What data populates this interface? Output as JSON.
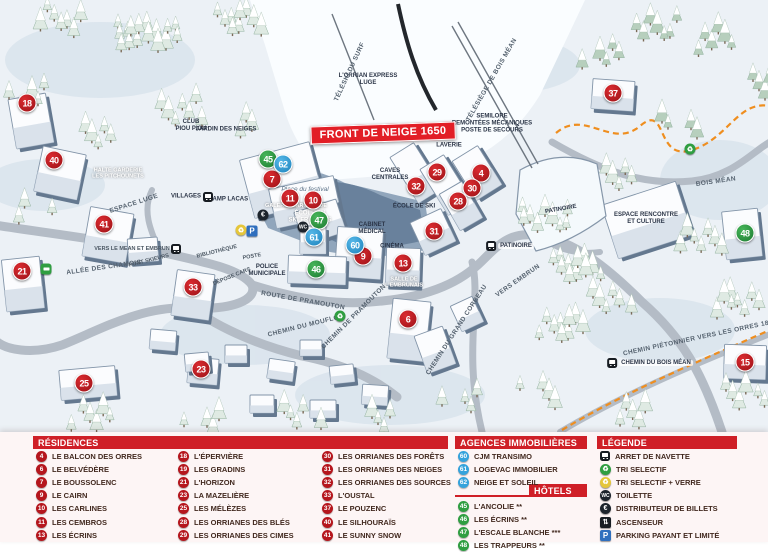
{
  "map": {
    "banner": {
      "text": "FRONT DE NEIGE 1650"
    },
    "labels": [
      {
        "name": "lift-orrian-express",
        "text": "L'ORRIAN EXPRESS\nLUGE",
        "x": 368,
        "y": 80,
        "rot": 0,
        "style": "dark"
      },
      {
        "name": "teleski-du-surf",
        "text": "TÉLÉSKI DU SURF",
        "x": 350,
        "y": 72,
        "rot": -65,
        "style": "road"
      },
      {
        "name": "telesiege-bois-mean",
        "text": "TÉLÉSIÈGE DE BOIS MÉAN",
        "x": 492,
        "y": 80,
        "rot": -60,
        "style": "road"
      },
      {
        "name": "semilore-remontees",
        "text": "SEMILORE\nREMONTÉES MÉCANIQUES\nPOSTE DE SECOURS",
        "x": 492,
        "y": 124,
        "rot": 0,
        "style": "dark"
      },
      {
        "name": "laverie",
        "text": "LAVERIE",
        "x": 449,
        "y": 146,
        "rot": 0,
        "style": "dark"
      },
      {
        "name": "club-piou-piou",
        "text": "CLUB\nPIOU PIOU",
        "x": 191,
        "y": 126,
        "rot": 0,
        "style": "dark"
      },
      {
        "name": "jardin-des-neiges",
        "text": "JARDIN DES NEIGES",
        "x": 226,
        "y": 130,
        "rot": 0,
        "style": "dark"
      },
      {
        "name": "halte-garderie",
        "text": "HALTE GARDERIE\nLES PITCHOUNETS",
        "x": 118,
        "y": 174,
        "rot": 0,
        "style": "onbld"
      },
      {
        "name": "espace-luge",
        "text": "ESPACE LUGE",
        "x": 134,
        "y": 204,
        "rot": -18,
        "style": "road"
      },
      {
        "name": "villages",
        "text": "VILLAGES",
        "x": 186,
        "y": 197,
        "rot": 0,
        "style": "dark"
      },
      {
        "name": "champ-lacas",
        "text": "CHAMP LACAS",
        "x": 226,
        "y": 200,
        "rot": 0,
        "style": "dark"
      },
      {
        "name": "place-du-festival",
        "text": "Place du festival",
        "x": 305,
        "y": 190,
        "rot": 0,
        "style": "italic"
      },
      {
        "name": "la-bulle-esf",
        "text": "LA BULLE\nÉCOLE DU\nSKI FRANÇAIS",
        "x": 310,
        "y": 214,
        "rot": 0,
        "style": "onblue"
      },
      {
        "name": "galerie-marchande",
        "text": "GALERIE MARCHANDE",
        "x": 296,
        "y": 206,
        "rot": 0,
        "style": "onbld"
      },
      {
        "name": "caves-centrales",
        "text": "CAVES\nCENTRALES",
        "x": 390,
        "y": 175,
        "rot": 0,
        "style": "dark"
      },
      {
        "name": "ecole-de-ski",
        "text": "ÉCOLE DE SKI",
        "x": 414,
        "y": 207,
        "rot": 0,
        "style": "dark"
      },
      {
        "name": "cabinet-medical",
        "text": "CABINET\nMÉDICAL",
        "x": 372,
        "y": 229,
        "rot": 0,
        "style": "dark"
      },
      {
        "name": "cinema",
        "text": "CINÉMA",
        "x": 392,
        "y": 247,
        "rot": 0,
        "style": "dark"
      },
      {
        "name": "salle-embrunais",
        "text": "SALLE DE\nL'EMBRUNAIS",
        "x": 404,
        "y": 283,
        "rot": 0,
        "style": "onbld"
      },
      {
        "name": "bibliotheque",
        "text": "BIBLIOTHÈQUE",
        "x": 217,
        "y": 252,
        "rot": -14,
        "style": "roadsm"
      },
      {
        "name": "poste",
        "text": "POSTE",
        "x": 252,
        "y": 257,
        "rot": -10,
        "style": "roadsm"
      },
      {
        "name": "depose-cars",
        "text": "DÉPOSE CARS",
        "x": 232,
        "y": 277,
        "rot": -22,
        "style": "roadsm"
      },
      {
        "name": "police-municipale",
        "text": "POLICE\nMUNICIPALE",
        "x": 267,
        "y": 271,
        "rot": 0,
        "style": "dark"
      },
      {
        "name": "route-de-pramouton",
        "text": "ROUTE DE PRAMOUTON",
        "x": 303,
        "y": 301,
        "rot": 10,
        "style": "road"
      },
      {
        "name": "chemin-du-mouflon",
        "text": "CHEMIN DU MOUFLON",
        "x": 306,
        "y": 326,
        "rot": -14,
        "style": "road"
      },
      {
        "name": "chemin-de-pramouton",
        "text": "CHEMIN DE PRAMOUTON",
        "x": 354,
        "y": 317,
        "rot": -45,
        "style": "road"
      },
      {
        "name": "chemin-grand-corbeau",
        "text": "CHEMIN DU GRAND CORBEAU",
        "x": 457,
        "y": 330,
        "rot": -57,
        "style": "road"
      },
      {
        "name": "vers-embrun",
        "text": "VERS EMBRUN",
        "x": 518,
        "y": 281,
        "rot": -35,
        "style": "road"
      },
      {
        "name": "allee-des-chamois",
        "text": "ALLÉE DES CHAMOIS",
        "x": 104,
        "y": 268,
        "rot": -8,
        "style": "road"
      },
      {
        "name": "pont-skieurs",
        "text": "PONT SKIEURS",
        "x": 149,
        "y": 261,
        "rot": -14,
        "style": "roadsm"
      },
      {
        "name": "vers-le-mean",
        "text": "VERS LE MEAN ET EMBRUN",
        "x": 132,
        "y": 249,
        "rot": 0,
        "style": "roadsm"
      },
      {
        "name": "chemin-pietonnier",
        "text": "CHEMIN PIÉTONNIER\nVERS LES ORRES 1800",
        "x": 700,
        "y": 338,
        "rot": -12,
        "style": "road"
      },
      {
        "name": "bois-mean",
        "text": "BOIS MÉAN",
        "x": 716,
        "y": 182,
        "rot": -8,
        "style": "road"
      },
      {
        "name": "patinoire-building",
        "text": "PATINOIRE",
        "x": 561,
        "y": 210,
        "rot": -10,
        "style": "dark"
      },
      {
        "name": "espace-rencontre",
        "text": "ESPACE RENCONTRE\nET CULTURE",
        "x": 646,
        "y": 219,
        "rot": 0,
        "style": "dark"
      }
    ],
    "markers": [
      {
        "n": "18",
        "color": "red",
        "x": 27,
        "y": 103
      },
      {
        "n": "40",
        "color": "red",
        "x": 54,
        "y": 160
      },
      {
        "n": "41",
        "color": "red",
        "x": 104,
        "y": 224
      },
      {
        "n": "21",
        "color": "red",
        "x": 22,
        "y": 271
      },
      {
        "n": "33",
        "color": "red",
        "x": 193,
        "y": 287
      },
      {
        "n": "25",
        "color": "red",
        "x": 84,
        "y": 383
      },
      {
        "n": "23",
        "color": "red",
        "x": 201,
        "y": 369
      },
      {
        "n": "7",
        "color": "red",
        "x": 272,
        "y": 179
      },
      {
        "n": "11",
        "color": "red",
        "x": 290,
        "y": 198
      },
      {
        "n": "10",
        "color": "red",
        "x": 313,
        "y": 200
      },
      {
        "n": "9",
        "color": "red",
        "x": 363,
        "y": 256
      },
      {
        "n": "13",
        "color": "red",
        "x": 403,
        "y": 263
      },
      {
        "n": "6",
        "color": "red",
        "x": 408,
        "y": 319
      },
      {
        "n": "29",
        "color": "red",
        "x": 437,
        "y": 172
      },
      {
        "n": "4",
        "color": "red",
        "x": 481,
        "y": 173
      },
      {
        "n": "32",
        "color": "red",
        "x": 416,
        "y": 186
      },
      {
        "n": "30",
        "color": "red",
        "x": 472,
        "y": 188
      },
      {
        "n": "28",
        "color": "red",
        "x": 458,
        "y": 201
      },
      {
        "n": "31",
        "color": "red",
        "x": 434,
        "y": 231
      },
      {
        "n": "37",
        "color": "red",
        "x": 613,
        "y": 93
      },
      {
        "n": "15",
        "color": "red",
        "x": 745,
        "y": 362
      },
      {
        "n": "45",
        "color": "green",
        "x": 268,
        "y": 159
      },
      {
        "n": "47",
        "color": "green",
        "x": 319,
        "y": 220
      },
      {
        "n": "46",
        "color": "green",
        "x": 316,
        "y": 269
      },
      {
        "n": "48",
        "color": "green",
        "x": 745,
        "y": 233
      },
      {
        "n": "62",
        "color": "blue",
        "x": 283,
        "y": 164
      },
      {
        "n": "61",
        "color": "blue",
        "x": 314,
        "y": 237
      },
      {
        "n": "60",
        "color": "blue",
        "x": 355,
        "y": 245
      }
    ],
    "icons": [
      {
        "type": "euro",
        "x": 263,
        "y": 215
      },
      {
        "type": "parking",
        "x": 252,
        "y": 231
      },
      {
        "type": "triverre",
        "x": 241,
        "y": 230
      },
      {
        "type": "wc",
        "x": 303,
        "y": 227
      },
      {
        "type": "busgreen",
        "x": 46,
        "y": 269
      },
      {
        "type": "recycle",
        "x": 340,
        "y": 316
      },
      {
        "type": "recycle",
        "x": 690,
        "y": 149
      }
    ],
    "bus_stops": [
      {
        "x": 208,
        "y": 197,
        "label": ""
      },
      {
        "x": 176,
        "y": 249,
        "label": ""
      },
      {
        "x": 510,
        "y": 246,
        "label": "PATINOIRE"
      },
      {
        "x": 650,
        "y": 363,
        "label": "CHEMIN DU BOIS MÉAN"
      }
    ]
  },
  "panel": {
    "residences": {
      "title": "RÉSIDENCES",
      "columns": [
        [
          {
            "n": "4",
            "label": "LE BALCON DES ORRES"
          },
          {
            "n": "6",
            "label": "LE BELVÉDÈRE"
          },
          {
            "n": "7",
            "label": "LE BOUSSOLENC"
          },
          {
            "n": "9",
            "label": "LE CAIRN"
          },
          {
            "n": "10",
            "label": "LES CARLINES"
          },
          {
            "n": "11",
            "label": "LES CEMBROS"
          },
          {
            "n": "13",
            "label": "LES ÉCRINS"
          }
        ],
        [
          {
            "n": "18",
            "label": "L'ÉPERVIÈRE"
          },
          {
            "n": "19",
            "label": "LES GRADINS"
          },
          {
            "n": "21",
            "label": "L'HORIZON"
          },
          {
            "n": "23",
            "label": "LA MAZELIÈRE"
          },
          {
            "n": "25",
            "label": "LES MÉLÈZES"
          },
          {
            "n": "28",
            "label": "LES ORRIANES DES BLÉS"
          },
          {
            "n": "29",
            "label": "LES ORRIANES DES CIMES"
          }
        ],
        [
          {
            "n": "30",
            "label": "LES ORRIANES DES FORÊTS"
          },
          {
            "n": "31",
            "label": "LES ORRIANES DES NEIGES"
          },
          {
            "n": "32",
            "label": "LES ORRIANES DES SOURCES"
          },
          {
            "n": "33",
            "label": "L'OUSTAL"
          },
          {
            "n": "37",
            "label": "LE POUZENC"
          },
          {
            "n": "40",
            "label": "LE SILHOURAÏS"
          },
          {
            "n": "41",
            "label": "LE SUNNY SNOW"
          }
        ]
      ]
    },
    "agences": {
      "title": "AGENCES IMMOBILIÈRES",
      "items": [
        {
          "n": "60",
          "label": "CJM TRANSIMO"
        },
        {
          "n": "61",
          "label": "LOGEVAC IMMOBILIER"
        },
        {
          "n": "62",
          "label": "NEIGE ET SOLEIL"
        }
      ]
    },
    "hotels": {
      "title": "HÔTELS",
      "items": [
        {
          "n": "45",
          "label": "L'ANCOLIE **"
        },
        {
          "n": "46",
          "label": "LES ÉCRINS **"
        },
        {
          "n": "47",
          "label": "L'ESCALE BLANCHE ***"
        },
        {
          "n": "48",
          "label": "LES TRAPPEURS **"
        }
      ]
    },
    "legende": {
      "title": "LÉGENDE",
      "items": [
        {
          "icon": "bus",
          "label": "ARRET DE NAVETTE"
        },
        {
          "icon": "recycle",
          "label": "TRI SELECTIF"
        },
        {
          "icon": "triverre",
          "label": "TRI SELECTIF + VERRE"
        },
        {
          "icon": "wc",
          "label": "TOILETTE"
        },
        {
          "icon": "euro",
          "label": "DISTRIBUTEUR DE BILLETS"
        },
        {
          "icon": "lift",
          "label": "ASCENSEUR"
        },
        {
          "icon": "parking",
          "label": "PARKING PAYANT ET LIMITÉ"
        }
      ]
    }
  },
  "colors": {
    "marker_red": "#c11d24",
    "marker_green": "#2f9e41",
    "marker_blue": "#35a3dc",
    "header_red": "#cf1f27",
    "banner_red": "#e21e26",
    "trail_orange": "#ef8e1f"
  }
}
